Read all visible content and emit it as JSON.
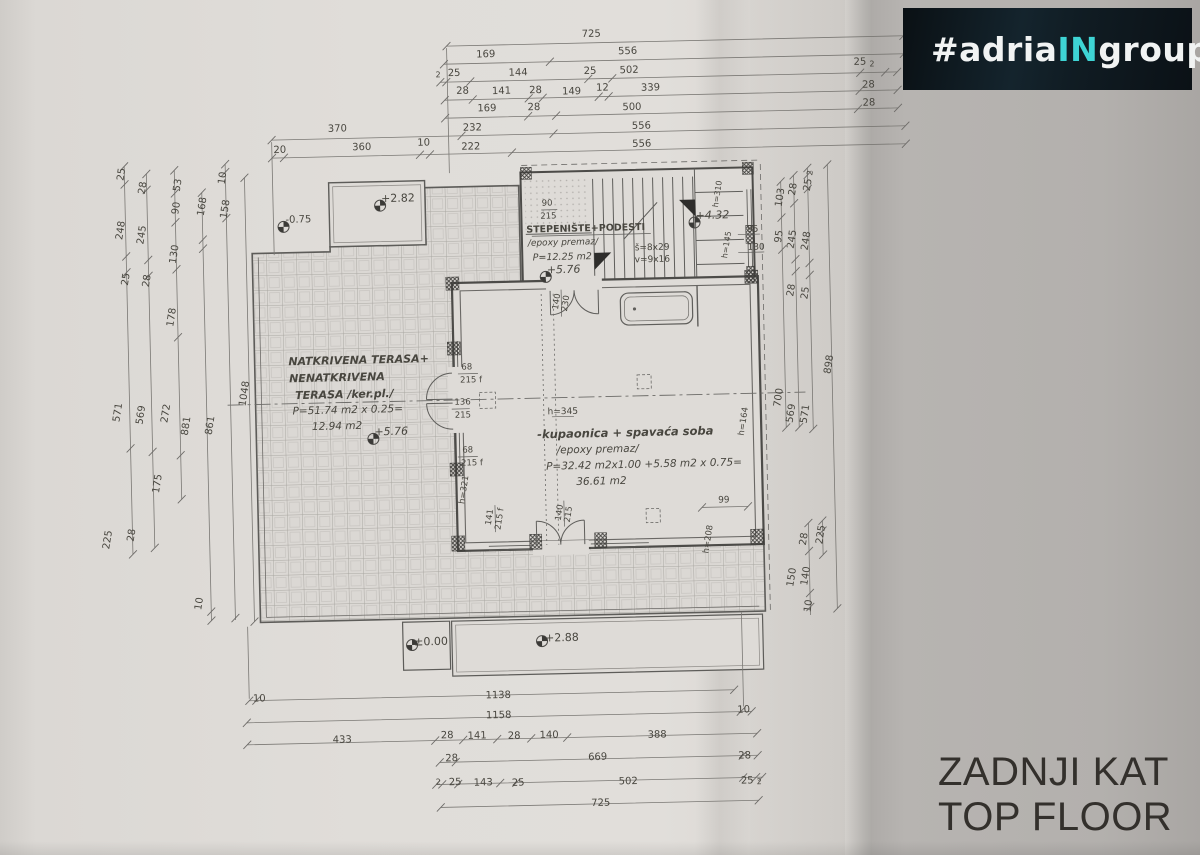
{
  "logo": {
    "prefix": "#adria",
    "accent": "IN",
    "suffix": "group",
    "accent_color": "#3ed4d4"
  },
  "title": {
    "line1": "ZADNJI KAT",
    "line2": "TOP FLOOR"
  },
  "plan": {
    "rooms": [
      {
        "name": "NATKRIVENA TERASA+ NENATKRIVENA TERASA",
        "finish": "/ker.pl./",
        "area_calc": "P=51.74 m2 x 0.25=",
        "area": "12.94 m2",
        "elevation": "+5.76"
      },
      {
        "name": "STEPENIŠTE+PODESTI",
        "finish": "/epoxy premaz/",
        "area": "P=12.25 m2",
        "elevation": "+5.76",
        "stairs": "š=8x29 v=9x16"
      },
      {
        "name": "-kupaonica + spavaća soba",
        "finish": "/epoxy premaz/",
        "area_calc": "P=32.42 m2x1.00 +5.58 m2 x 0.75=",
        "area": "36.61 m2"
      }
    ],
    "elevation_markers": [
      "+2.82",
      "-0.75",
      "+5.76",
      "+5.76",
      "+4.32",
      "±0.00",
      "+2.88"
    ],
    "annotations": [
      {
        "g": "dt",
        "t": "725",
        "x": 600,
        "y": 37
      },
      {
        "g": "dt",
        "t": "169",
        "x": 494,
        "y": 55
      },
      {
        "g": "dt",
        "t": "556",
        "x": 636,
        "y": 55
      },
      {
        "g": "dt",
        "t": "2",
        "x": 446,
        "y": 74,
        "s": 8
      },
      {
        "g": "dt",
        "t": "25",
        "x": 462,
        "y": 73
      },
      {
        "g": "dt",
        "t": "144",
        "x": 526,
        "y": 74
      },
      {
        "g": "dt",
        "t": "25",
        "x": 598,
        "y": 74
      },
      {
        "g": "dt",
        "t": "502",
        "x": 637,
        "y": 74
      },
      {
        "g": "dt",
        "t": "25",
        "x": 868,
        "y": 71
      },
      {
        "g": "dt",
        "t": "2",
        "x": 880,
        "y": 73,
        "s": 8
      },
      {
        "g": "dt",
        "t": "28",
        "x": 470,
        "y": 91
      },
      {
        "g": "dt",
        "t": "141",
        "x": 509,
        "y": 92
      },
      {
        "g": "dt",
        "t": "28",
        "x": 543,
        "y": 92
      },
      {
        "g": "dt",
        "t": "149",
        "x": 579,
        "y": 94
      },
      {
        "g": "dt",
        "t": "12",
        "x": 610,
        "y": 91
      },
      {
        "g": "dt",
        "t": "339",
        "x": 658,
        "y": 92
      },
      {
        "g": "dt",
        "t": "28",
        "x": 876,
        "y": 94
      },
      {
        "g": "dt",
        "t": "169",
        "x": 494,
        "y": 109
      },
      {
        "g": "dt",
        "t": "28",
        "x": 541,
        "y": 109
      },
      {
        "g": "dt",
        "t": "500",
        "x": 639,
        "y": 111
      },
      {
        "g": "dt",
        "t": "28",
        "x": 876,
        "y": 112
      },
      {
        "g": "dt",
        "t": "370",
        "x": 344,
        "y": 126
      },
      {
        "g": "dt",
        "t": "232",
        "x": 479,
        "y": 128
      },
      {
        "g": "dt",
        "t": "556",
        "x": 648,
        "y": 130
      },
      {
        "g": "dt",
        "t": "20",
        "x": 286,
        "y": 146
      },
      {
        "g": "dt",
        "t": "360",
        "x": 368,
        "y": 145
      },
      {
        "g": "dt",
        "t": "10",
        "x": 430,
        "y": 142
      },
      {
        "g": "dt",
        "t": "222",
        "x": 477,
        "y": 147
      },
      {
        "g": "dt",
        "t": "556",
        "x": 648,
        "y": 148
      },
      {
        "g": "dl",
        "t": "25",
        "x": 128,
        "y": 166,
        "r": -80
      },
      {
        "g": "dl",
        "t": "248",
        "x": 126,
        "y": 222,
        "r": -80
      },
      {
        "g": "dl",
        "t": "25",
        "x": 130,
        "y": 271,
        "r": -80
      },
      {
        "g": "dl",
        "t": "571",
        "x": 119,
        "y": 404,
        "r": -80
      },
      {
        "g": "dl",
        "t": "225",
        "x": 106,
        "y": 531,
        "r": -80
      },
      {
        "g": "dl",
        "t": "28",
        "x": 149,
        "y": 180,
        "r": -80
      },
      {
        "g": "dl",
        "t": "245",
        "x": 147,
        "y": 227,
        "r": -80
      },
      {
        "g": "dl",
        "t": "28",
        "x": 151,
        "y": 273,
        "r": -80
      },
      {
        "g": "dl",
        "t": "569",
        "x": 142,
        "y": 407,
        "r": -80
      },
      {
        "g": "dl",
        "t": "28",
        "x": 130,
        "y": 527,
        "r": -80
      },
      {
        "g": "dl",
        "t": "53",
        "x": 184,
        "y": 178,
        "r": -80
      },
      {
        "g": "dl",
        "t": "90",
        "x": 182,
        "y": 201,
        "r": -80
      },
      {
        "g": "dl",
        "t": "130",
        "x": 179,
        "y": 247,
        "r": -80
      },
      {
        "g": "dl",
        "t": "178",
        "x": 175,
        "y": 310,
        "r": -80
      },
      {
        "g": "dl",
        "t": "272",
        "x": 167,
        "y": 406,
        "r": -80
      },
      {
        "g": "dl",
        "t": "175",
        "x": 157,
        "y": 476,
        "r": -80
      },
      {
        "g": "dl",
        "t": "168",
        "x": 208,
        "y": 200,
        "r": -80
      },
      {
        "g": "dl",
        "t": "881",
        "x": 187,
        "y": 419,
        "r": -80
      },
      {
        "g": "dl",
        "t": "10",
        "x": 196,
        "y": 597,
        "r": -80
      },
      {
        "g": "dl",
        "t": "10",
        "x": 229,
        "y": 172,
        "r": -80
      },
      {
        "g": "dl",
        "t": "158",
        "x": 231,
        "y": 203,
        "r": -80
      },
      {
        "g": "dl",
        "t": "861",
        "x": 211,
        "y": 419,
        "r": -80
      },
      {
        "g": "dl",
        "t": "1048",
        "x": 246,
        "y": 388,
        "r": -80
      },
      {
        "g": "dr",
        "t": "103",
        "x": 786,
        "y": 204,
        "r": -80
      },
      {
        "g": "dr",
        "t": "95",
        "x": 784,
        "y": 243,
        "r": -80
      },
      {
        "g": "dr",
        "t": "700",
        "x": 780,
        "y": 404,
        "r": -80
      },
      {
        "g": "dr",
        "t": "28",
        "x": 799,
        "y": 196,
        "r": -80
      },
      {
        "g": "dr",
        "t": "245",
        "x": 797,
        "y": 246,
        "r": -80
      },
      {
        "g": "dr",
        "t": "28",
        "x": 795,
        "y": 297,
        "r": -80
      },
      {
        "g": "dr",
        "t": "569",
        "x": 792,
        "y": 420,
        "r": -80
      },
      {
        "g": "dr",
        "t": "2",
        "x": 816,
        "y": 180,
        "r": -80,
        "s": 8
      },
      {
        "g": "dr",
        "t": "25",
        "x": 814,
        "y": 192,
        "r": -80
      },
      {
        "g": "dr",
        "t": "248",
        "x": 811,
        "y": 248,
        "r": -80
      },
      {
        "g": "dr",
        "t": "25",
        "x": 809,
        "y": 300,
        "r": -80
      },
      {
        "g": "dr",
        "t": "571",
        "x": 806,
        "y": 421,
        "r": -80
      },
      {
        "g": "dr",
        "t": "898",
        "x": 831,
        "y": 372,
        "r": -80
      },
      {
        "g": "dr",
        "t": "95",
        "x": 757,
        "y": 236,
        "s": 9
      },
      {
        "g": "dr",
        "t": "130",
        "x": 760,
        "y": 254,
        "s": 9
      },
      {
        "g": "dr",
        "t": "28",
        "x": 802,
        "y": 546,
        "r": -80
      },
      {
        "g": "dr",
        "t": "150",
        "x": 789,
        "y": 584,
        "r": -80
      },
      {
        "g": "dr",
        "t": "140",
        "x": 803,
        "y": 583,
        "r": -80
      },
      {
        "g": "dr",
        "t": "10",
        "x": 805,
        "y": 613,
        "r": -80
      },
      {
        "g": "dr",
        "t": "225",
        "x": 819,
        "y": 542,
        "r": -80
      },
      {
        "g": "db",
        "t": "10",
        "x": 253,
        "y": 694
      },
      {
        "g": "db",
        "t": "1138",
        "x": 492,
        "y": 696
      },
      {
        "g": "db",
        "t": "1158",
        "x": 492,
        "y": 716
      },
      {
        "g": "db",
        "t": "10",
        "x": 737,
        "y": 716
      },
      {
        "g": "db",
        "t": "433",
        "x": 335,
        "y": 737
      },
      {
        "g": "db",
        "t": "28",
        "x": 440,
        "y": 735
      },
      {
        "g": "db",
        "t": "141",
        "x": 470,
        "y": 736
      },
      {
        "g": "db",
        "t": "28",
        "x": 507,
        "y": 737
      },
      {
        "g": "db",
        "t": "140",
        "x": 542,
        "y": 737
      },
      {
        "g": "db",
        "t": "388",
        "x": 650,
        "y": 739
      },
      {
        "g": "db",
        "t": "28",
        "x": 444,
        "y": 758
      },
      {
        "g": "db",
        "t": "669",
        "x": 590,
        "y": 760
      },
      {
        "g": "db",
        "t": "28",
        "x": 737,
        "y": 762
      },
      {
        "g": "db",
        "t": "2",
        "x": 430,
        "y": 781,
        "s": 8
      },
      {
        "g": "db",
        "t": "25",
        "x": 447,
        "y": 782
      },
      {
        "g": "db",
        "t": "143",
        "x": 475,
        "y": 783
      },
      {
        "g": "db",
        "t": "25",
        "x": 510,
        "y": 784
      },
      {
        "g": "db",
        "t": "502",
        "x": 620,
        "y": 785
      },
      {
        "g": "db",
        "t": "25",
        "x": 739,
        "y": 787
      },
      {
        "g": "db",
        "t": "2",
        "x": 751,
        "y": 788,
        "s": 8
      },
      {
        "g": "db",
        "t": "725",
        "x": 592,
        "y": 806
      },
      {
        "g": "rm",
        "t": "NATKRIVENA TERASA+",
        "x": 360,
        "y": 357,
        "s": 11,
        "f": "bi"
      },
      {
        "g": "rm",
        "t": "NENATKRIVENA",
        "x": 338,
        "y": 374,
        "s": 11,
        "f": "bi"
      },
      {
        "g": "rm",
        "t": "TERASA /ker.pl./",
        "x": 345,
        "y": 391,
        "s": 11,
        "f": "bi"
      },
      {
        "g": "rm",
        "t": "P=51.74 m2 x 0.25=",
        "x": 348,
        "y": 407,
        "s": 10.5,
        "f": "i"
      },
      {
        "g": "rm",
        "t": "12.94 m2",
        "x": 337,
        "y": 423,
        "s": 10.5,
        "f": "i"
      },
      {
        "g": "rm",
        "t": "STEPENIŠTE+PODESTI",
        "x": 590,
        "y": 231,
        "s": 9.5,
        "f": "b"
      },
      {
        "g": "rm",
        "t": "/epoxy premaz/",
        "x": 567,
        "y": 245,
        "s": 9,
        "f": "i"
      },
      {
        "g": "rm",
        "t": "P=12.25 m2",
        "x": 566,
        "y": 259,
        "s": 9.5,
        "f": "i"
      },
      {
        "g": "rm",
        "t": "š=8x29",
        "x": 656,
        "y": 252,
        "s": 9
      },
      {
        "g": "rm",
        "t": "v=9x16",
        "x": 656,
        "y": 264,
        "s": 9
      },
      {
        "g": "rm",
        "t": "-kupaonica + spavaća soba",
        "x": 625,
        "y": 436,
        "s": 11.5,
        "f": "bi"
      },
      {
        "g": "rm",
        "t": "/epoxy premaz/",
        "x": 597,
        "y": 452,
        "s": 10.5,
        "f": "i"
      },
      {
        "g": "rm",
        "t": "P=32.42 m2x1.00 +5.58 m2 x 0.75=",
        "x": 643,
        "y": 468,
        "s": 10.5,
        "f": "i"
      },
      {
        "g": "rm",
        "t": "36.61 m2",
        "x": 600,
        "y": 484,
        "s": 10.5,
        "f": "i"
      },
      {
        "g": "el",
        "t": "+2.82",
        "x": 403,
        "y": 196,
        "s": 11
      },
      {
        "g": "el",
        "t": "-0.75",
        "x": 303,
        "y": 216,
        "s": 10
      },
      {
        "g": "el",
        "t": "+5.76",
        "x": 391,
        "y": 429,
        "s": 11,
        "f": "i"
      },
      {
        "g": "el",
        "t": "+5.76",
        "x": 567,
        "y": 271,
        "s": 11,
        "f": "i"
      },
      {
        "g": "el",
        "t": "+4.32",
        "x": 717,
        "y": 220,
        "s": 11,
        "f": "i"
      },
      {
        "g": "el",
        "t": "±0.00",
        "x": 426,
        "y": 640,
        "s": 11
      },
      {
        "g": "el",
        "t": "+2.88",
        "x": 557,
        "y": 639,
        "s": 11
      },
      {
        "g": "op",
        "t": "90",
        "x": 552,
        "y": 205,
        "s": 8.5
      },
      {
        "g": "op",
        "t": "215",
        "x": 553,
        "y": 218,
        "s": 8.5
      },
      {
        "g": "op",
        "t": "68",
        "x": 468,
        "y": 367,
        "s": 8.5
      },
      {
        "g": "op",
        "t": "215 f",
        "x": 472,
        "y": 380,
        "s": 8.5
      },
      {
        "g": "op",
        "t": "136",
        "x": 463,
        "y": 402,
        "s": 8.5
      },
      {
        "g": "op",
        "t": "215",
        "x": 463,
        "y": 415,
        "s": 8.5
      },
      {
        "g": "op",
        "t": "68",
        "x": 467,
        "y": 450,
        "s": 8.5
      },
      {
        "g": "op",
        "t": "215 f",
        "x": 471,
        "y": 463,
        "s": 8.5
      },
      {
        "g": "op",
        "t": "h=321",
        "x": 463,
        "y": 489,
        "s": 8.5,
        "r": -80
      },
      {
        "g": "op",
        "t": "141",
        "x": 488,
        "y": 517,
        "s": 8.5,
        "r": -80
      },
      {
        "g": "op",
        "t": "215 f",
        "x": 498,
        "y": 519,
        "s": 8.5,
        "r": -80
      },
      {
        "g": "op",
        "t": "140",
        "x": 558,
        "y": 514,
        "s": 8.5,
        "r": -80
      },
      {
        "g": "op",
        "t": "215",
        "x": 567,
        "y": 516,
        "s": 8.5,
        "r": -80
      },
      {
        "g": "op",
        "t": "140",
        "x": 560,
        "y": 303,
        "s": 8.5,
        "r": -80
      },
      {
        "g": "op",
        "t": "230",
        "x": 569,
        "y": 305,
        "s": 8.5,
        "r": -80
      },
      {
        "g": "op",
        "t": "h=164",
        "x": 744,
        "y": 427,
        "s": 8.5,
        "r": -80
      },
      {
        "g": "op",
        "t": "h=208",
        "x": 706,
        "y": 544,
        "s": 8.5,
        "r": -80
      },
      {
        "g": "op",
        "t": "h=310",
        "x": 723,
        "y": 199,
        "s": 8,
        "r": -80
      },
      {
        "g": "op",
        "t": "h=145",
        "x": 731,
        "y": 250,
        "s": 8,
        "r": -80
      },
      {
        "g": "op",
        "t": "h=345",
        "x": 563,
        "y": 414,
        "s": 9
      },
      {
        "g": "op",
        "t": "99",
        "x": 722,
        "y": 506,
        "s": 9
      }
    ]
  }
}
